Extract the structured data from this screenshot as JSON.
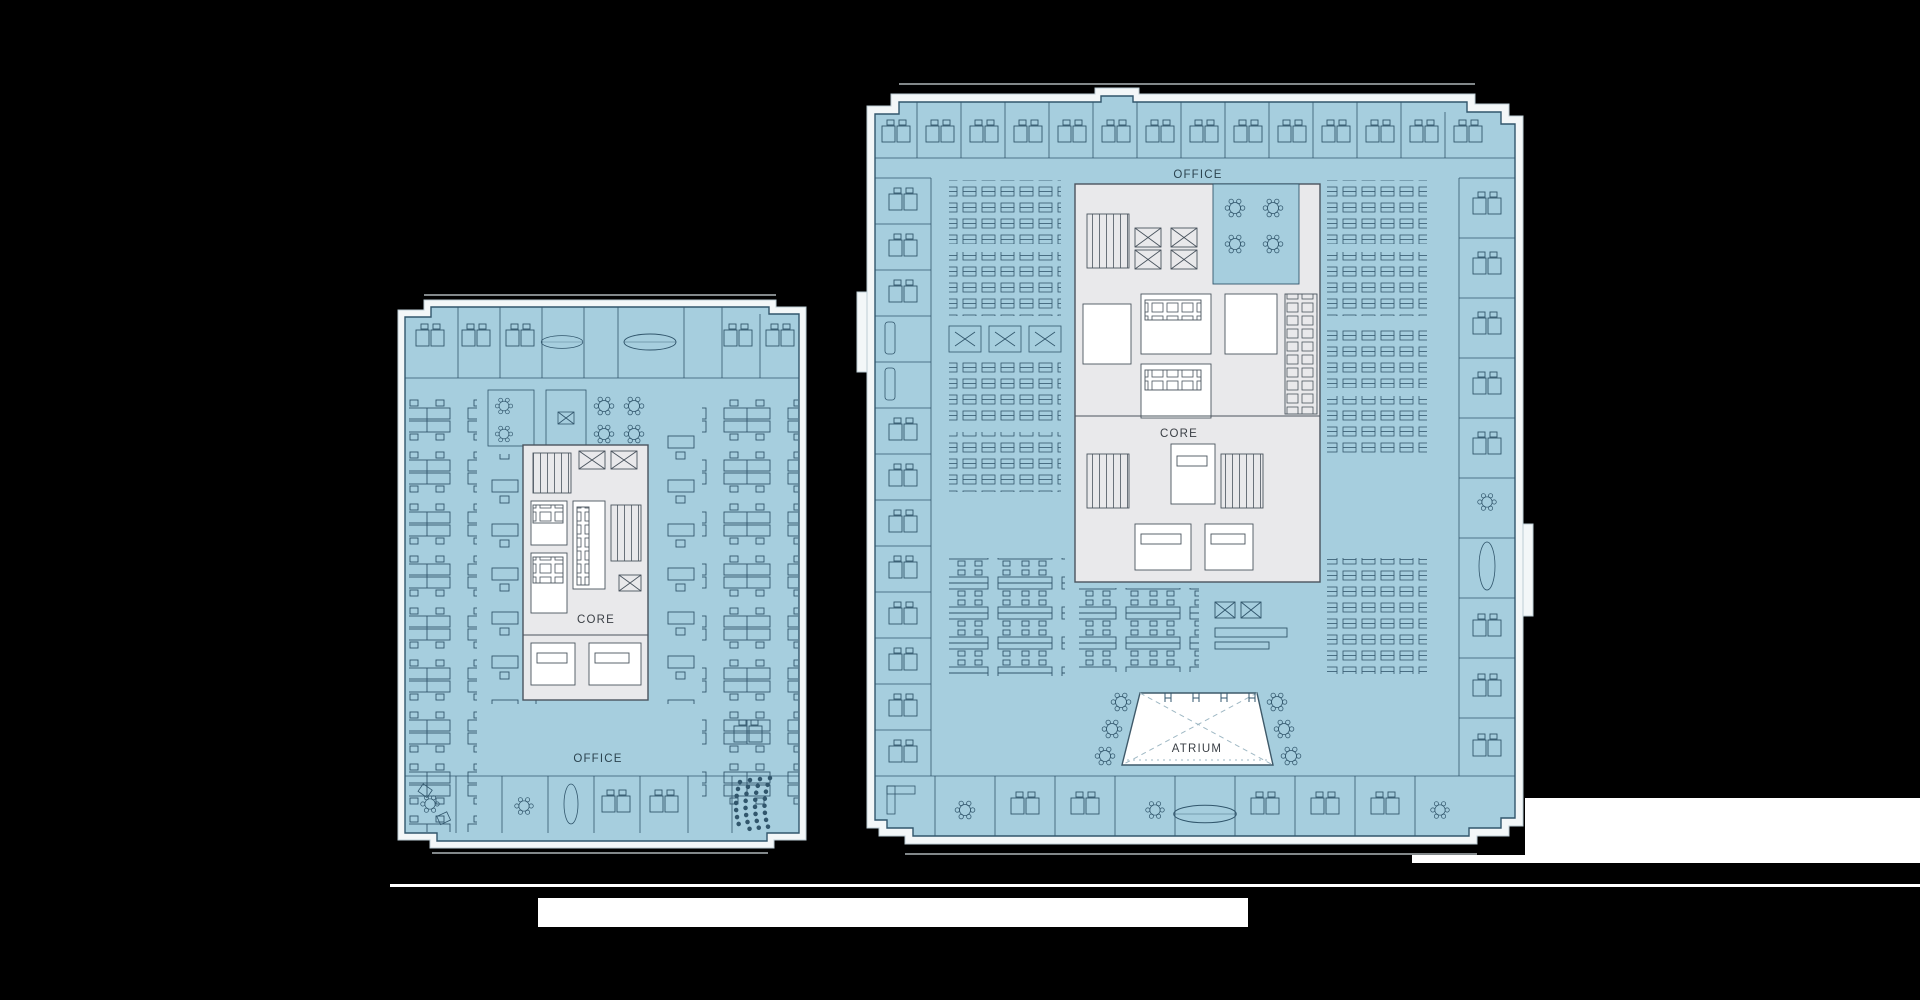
{
  "slide": {
    "background": "#000000"
  },
  "palette": {
    "floor_fill": "#a6cede",
    "floor_line": "#31566c",
    "floor_line_light": "#6e95a9",
    "wall_band": "#f3f7f8",
    "wall_edge": "#bccdd5",
    "core_fill": "#e9e9eb",
    "core_line": "#4a545e",
    "white": "#ffffff",
    "label_on_core": "#3a3f45",
    "label_on_floor": "#2c4450"
  },
  "plans": {
    "left": {
      "labels": {
        "core": "CORE",
        "office": "OFFICE"
      }
    },
    "right": {
      "labels": {
        "office": "OFFICE",
        "core": "CORE",
        "atrium": "ATRIUM"
      }
    }
  }
}
